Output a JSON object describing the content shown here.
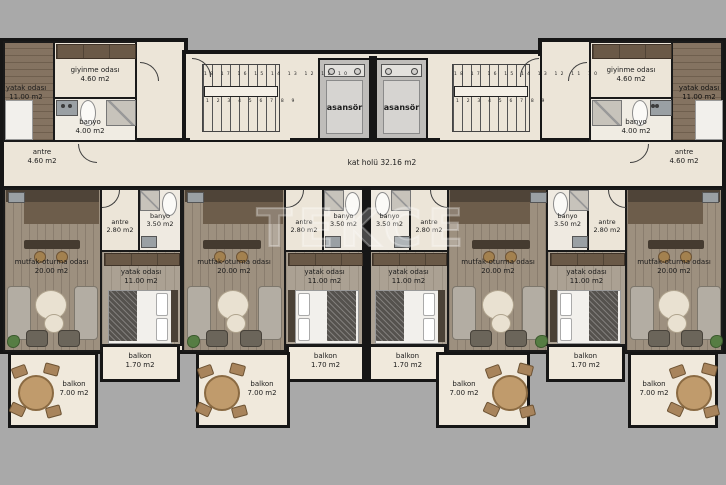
{
  "title": "apartment floor plan",
  "watermark": "TEKCE",
  "colors": {
    "background": "#a9a9a9",
    "floor": "#ece5d8",
    "wall": "#161616",
    "wood": "#998b7a",
    "kitchen": "#4f4438",
    "elevator": "#bfbdba"
  },
  "hall": {
    "name": "kat holü",
    "area": "32.16 m2"
  },
  "core": {
    "elevators": [
      {
        "label": "asansör"
      },
      {
        "label": "asansör"
      }
    ],
    "stairs": {
      "row_top": "18 17 16 15 14 13 12 11 10",
      "row_bottom": "1 2 3 4 5 6 7 8 9"
    }
  },
  "top_units": {
    "left": {
      "bedroom": {
        "name": "yatak odası",
        "area": "11.00 m2"
      },
      "dressing": {
        "name": "giyinme odası",
        "area": "4.60 m2"
      },
      "bath": {
        "name": "banyo",
        "area": "4.00 m2"
      },
      "entry": {
        "name": "antre",
        "area": "4.60 m2"
      }
    },
    "right": {
      "bedroom": {
        "name": "yatak odası",
        "area": "11.00 m2"
      },
      "dressing": {
        "name": "giyinme odası",
        "area": "4.60 m2"
      },
      "bath": {
        "name": "banyo",
        "area": "4.00 m2"
      },
      "entry": {
        "name": "antre",
        "area": "4.60 m2"
      }
    }
  },
  "units": [
    {
      "living": {
        "name": "mutfak-oturma odası",
        "area": "20.00 m2"
      },
      "entry": {
        "name": "antre",
        "area": "2.80 m2"
      },
      "bath": {
        "name": "banyo",
        "area": "3.50 m2"
      },
      "bedroom": {
        "name": "yatak odası",
        "area": "11.00 m2"
      },
      "balcony_small": {
        "name": "balkon",
        "area": "1.70 m2"
      },
      "balcony_large": {
        "name": "balkon",
        "area": "7.00 m2"
      }
    },
    {
      "living": {
        "name": "mutfak-oturma odası",
        "area": "20.00 m2"
      },
      "entry": {
        "name": "antre",
        "area": "2.80 m2"
      },
      "bath": {
        "name": "banyo",
        "area": "3.50 m2"
      },
      "bedroom": {
        "name": "yatak odası",
        "area": "11.00 m2"
      },
      "balcony_small": {
        "name": "balkon",
        "area": "1.70 m2"
      },
      "balcony_large": {
        "name": "balkon",
        "area": "7.00 m2"
      }
    },
    {
      "living": {
        "name": "mutfak-oturma odası",
        "area": "20.00 m2"
      },
      "entry": {
        "name": "antre",
        "area": "2.80 m2"
      },
      "bath": {
        "name": "banyo",
        "area": "3.50 m2"
      },
      "bedroom": {
        "name": "yatak odası",
        "area": "11.00 m2"
      },
      "balcony_small": {
        "name": "balkon",
        "area": "1.70 m2"
      },
      "balcony_large": {
        "name": "balkon",
        "area": "7.00 m2"
      }
    },
    {
      "living": {
        "name": "mutfak-oturma odası",
        "area": "20.00 m2"
      },
      "entry": {
        "name": "antre",
        "area": "2.80 m2"
      },
      "bath": {
        "name": "banyo",
        "area": "3.50 m2"
      },
      "bedroom": {
        "name": "yatak odası",
        "area": "11.00 m2"
      },
      "balcony_small": {
        "name": "balkon",
        "area": "1.70 m2"
      },
      "balcony_large": {
        "name": "balkon",
        "area": "7.00 m2"
      }
    }
  ]
}
